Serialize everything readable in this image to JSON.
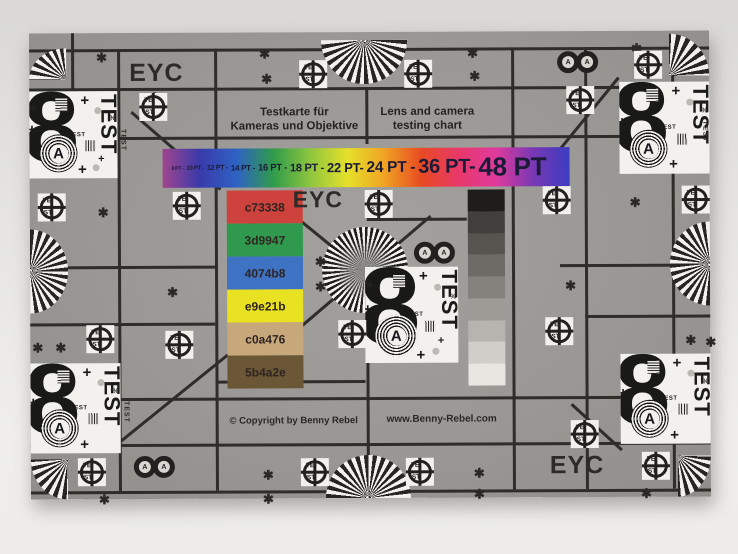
{
  "texts": {
    "eyc": "EYC",
    "copyright": "© Copyright by Benny Rebel",
    "website": "www.Benny-Rebel.com"
  },
  "titles": {
    "de1": "Testkarte für",
    "de2": "Kameras und Objektive",
    "en1": "Lens and camera",
    "en2": "testing chart"
  },
  "rainbow": {
    "labels": [
      "8 PT -",
      "10 PT -",
      "12 PT -",
      "14 PT -",
      "16 PT -",
      "18 PT -",
      "22 PT-",
      "24 PT -",
      "36 PT-",
      "48 PT"
    ],
    "gradient_colors": [
      "#a0458e",
      "#3a3aaa",
      "#2e62c4",
      "#2f9c4a",
      "#8fc63e",
      "#e6e02a",
      "#f0a224",
      "#e84a22",
      "#e8386a",
      "#e03a9c",
      "#7a38b4",
      "#3c3cc2"
    ],
    "text_color": "#1b1b38"
  },
  "swatches": [
    {
      "label": "c73338",
      "color": "#cd423c"
    },
    {
      "label": "3d9947",
      "color": "#2f9a4d"
    },
    {
      "label": "4074b8",
      "color": "#3e72c2"
    },
    {
      "label": "e9e21b",
      "color": "#e8e222"
    },
    {
      "label": "c0a476",
      "color": "#c6a87a"
    },
    {
      "label": "5b4a2e",
      "color": "#6b5736"
    }
  ],
  "grayscale": {
    "steps": [
      "#1e1d1b",
      "#403f3b",
      "#56544f",
      "#6d6b66",
      "#84827d",
      "#9d9b96",
      "#b6b4af",
      "#d0cec9",
      "#e8e6e1"
    ]
  },
  "glyphs": {
    "eight": "8",
    "a": "A",
    "test": "TEST",
    "te": "TE",
    "st": "ST",
    "asterisk": "✱",
    "plus": "+",
    "percent": "%"
  },
  "colors": {
    "card_gray": "#9a9894",
    "grid_line": "#2f2d2a",
    "patch_white": "#f2f1ed",
    "photo_background": "#e7e6e4",
    "text_dark": "#2a2826"
  }
}
